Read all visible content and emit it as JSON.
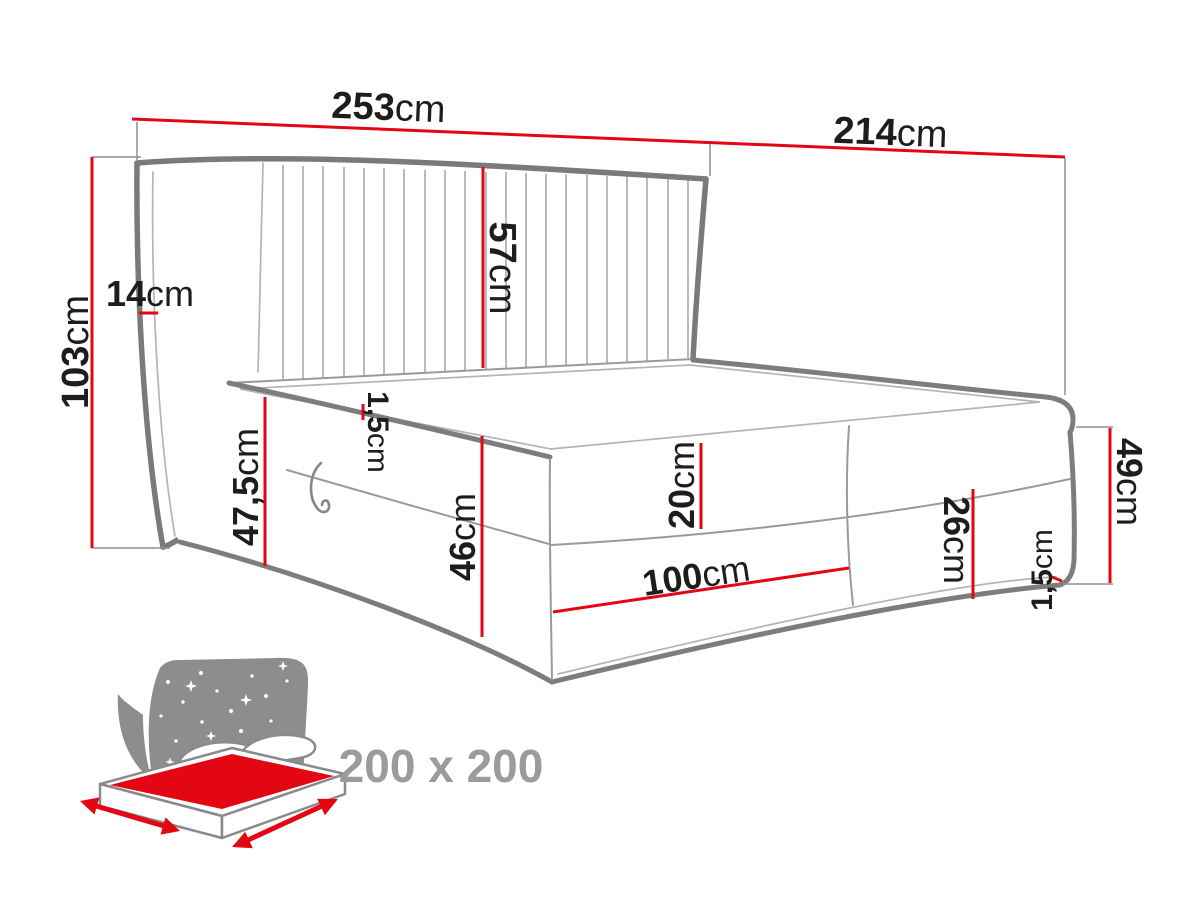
{
  "diagram": {
    "title": "boxspring-bed-dimension-diagram",
    "colors": {
      "dimension_red": "#e30613",
      "outline_gray": "#7a7a7a",
      "thin_line_gray": "#b4b4b4",
      "icon_gray": "#8d8d8d",
      "badge_gray": "#9b9b9b",
      "text_black": "#1d1d1b"
    },
    "dims": {
      "width_total": {
        "value": "253",
        "unit": "cm"
      },
      "depth_total": {
        "value": "214",
        "unit": "cm"
      },
      "headboard_height": {
        "value": "103",
        "unit": "cm"
      },
      "wing_depth": {
        "value": "14",
        "unit": "cm"
      },
      "headboard_panel": {
        "value": "57",
        "unit": "cm"
      },
      "top_piping": {
        "value": "1,5",
        "unit": "cm"
      },
      "side_height": {
        "value": "47,5",
        "unit": "cm"
      },
      "box_height": {
        "value": "46",
        "unit": "cm"
      },
      "topper_height": {
        "value": "20",
        "unit": "cm"
      },
      "drawer_width": {
        "value": "100",
        "unit": "cm"
      },
      "foot_panel_height": {
        "value": "26",
        "unit": "cm"
      },
      "foot_total_height": {
        "value": "49",
        "unit": "cm"
      },
      "bottom_piping": {
        "value": "1,5",
        "unit": "cm"
      }
    },
    "badge": {
      "size_label": "200 x 200"
    },
    "icons": [
      {
        "name": "bed-with-starry-headboard-icon",
        "meaning": "mattress surface size pictogram"
      }
    ]
  }
}
